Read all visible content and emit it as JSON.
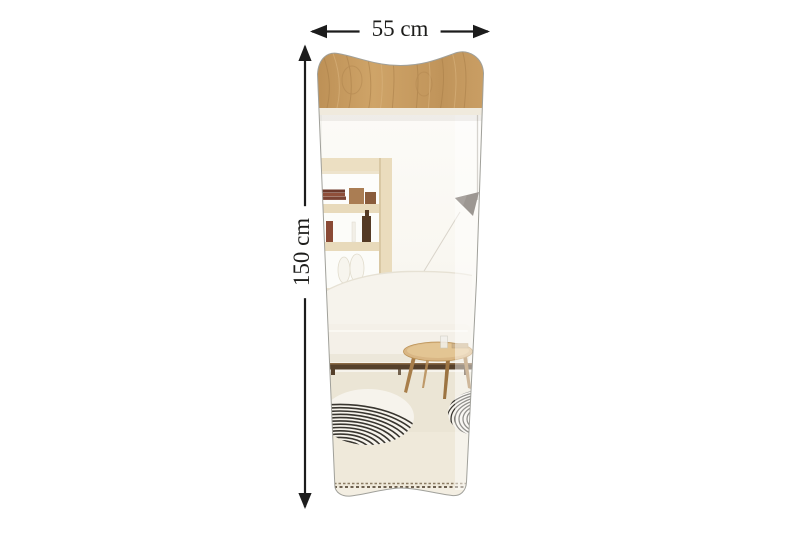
{
  "dimensions": {
    "width_label": "55 cm",
    "height_label": "150 cm"
  },
  "icons": {
    "width_arrow": "double-headed-horizontal-arrow-icon",
    "height_arrow": "double-headed-vertical-arrow-icon"
  },
  "colors": {
    "background": "#ffffff",
    "annotation": "#1c1c1c",
    "wood_top": "#c39759",
    "wood_grain": "#a67c47",
    "mirror_edge": "#a0a09a",
    "wall": "#fbfaf6",
    "shelf_wood": "#e9dcbf",
    "lamp_shade": "#4b423a",
    "sofa": "#f6f3ec",
    "sofa_base": "#55402b",
    "table_wood": "#d9b684",
    "carpet": "#ebe5d5",
    "rug_stripe": "#38352f",
    "fringe": "#6e6150"
  }
}
